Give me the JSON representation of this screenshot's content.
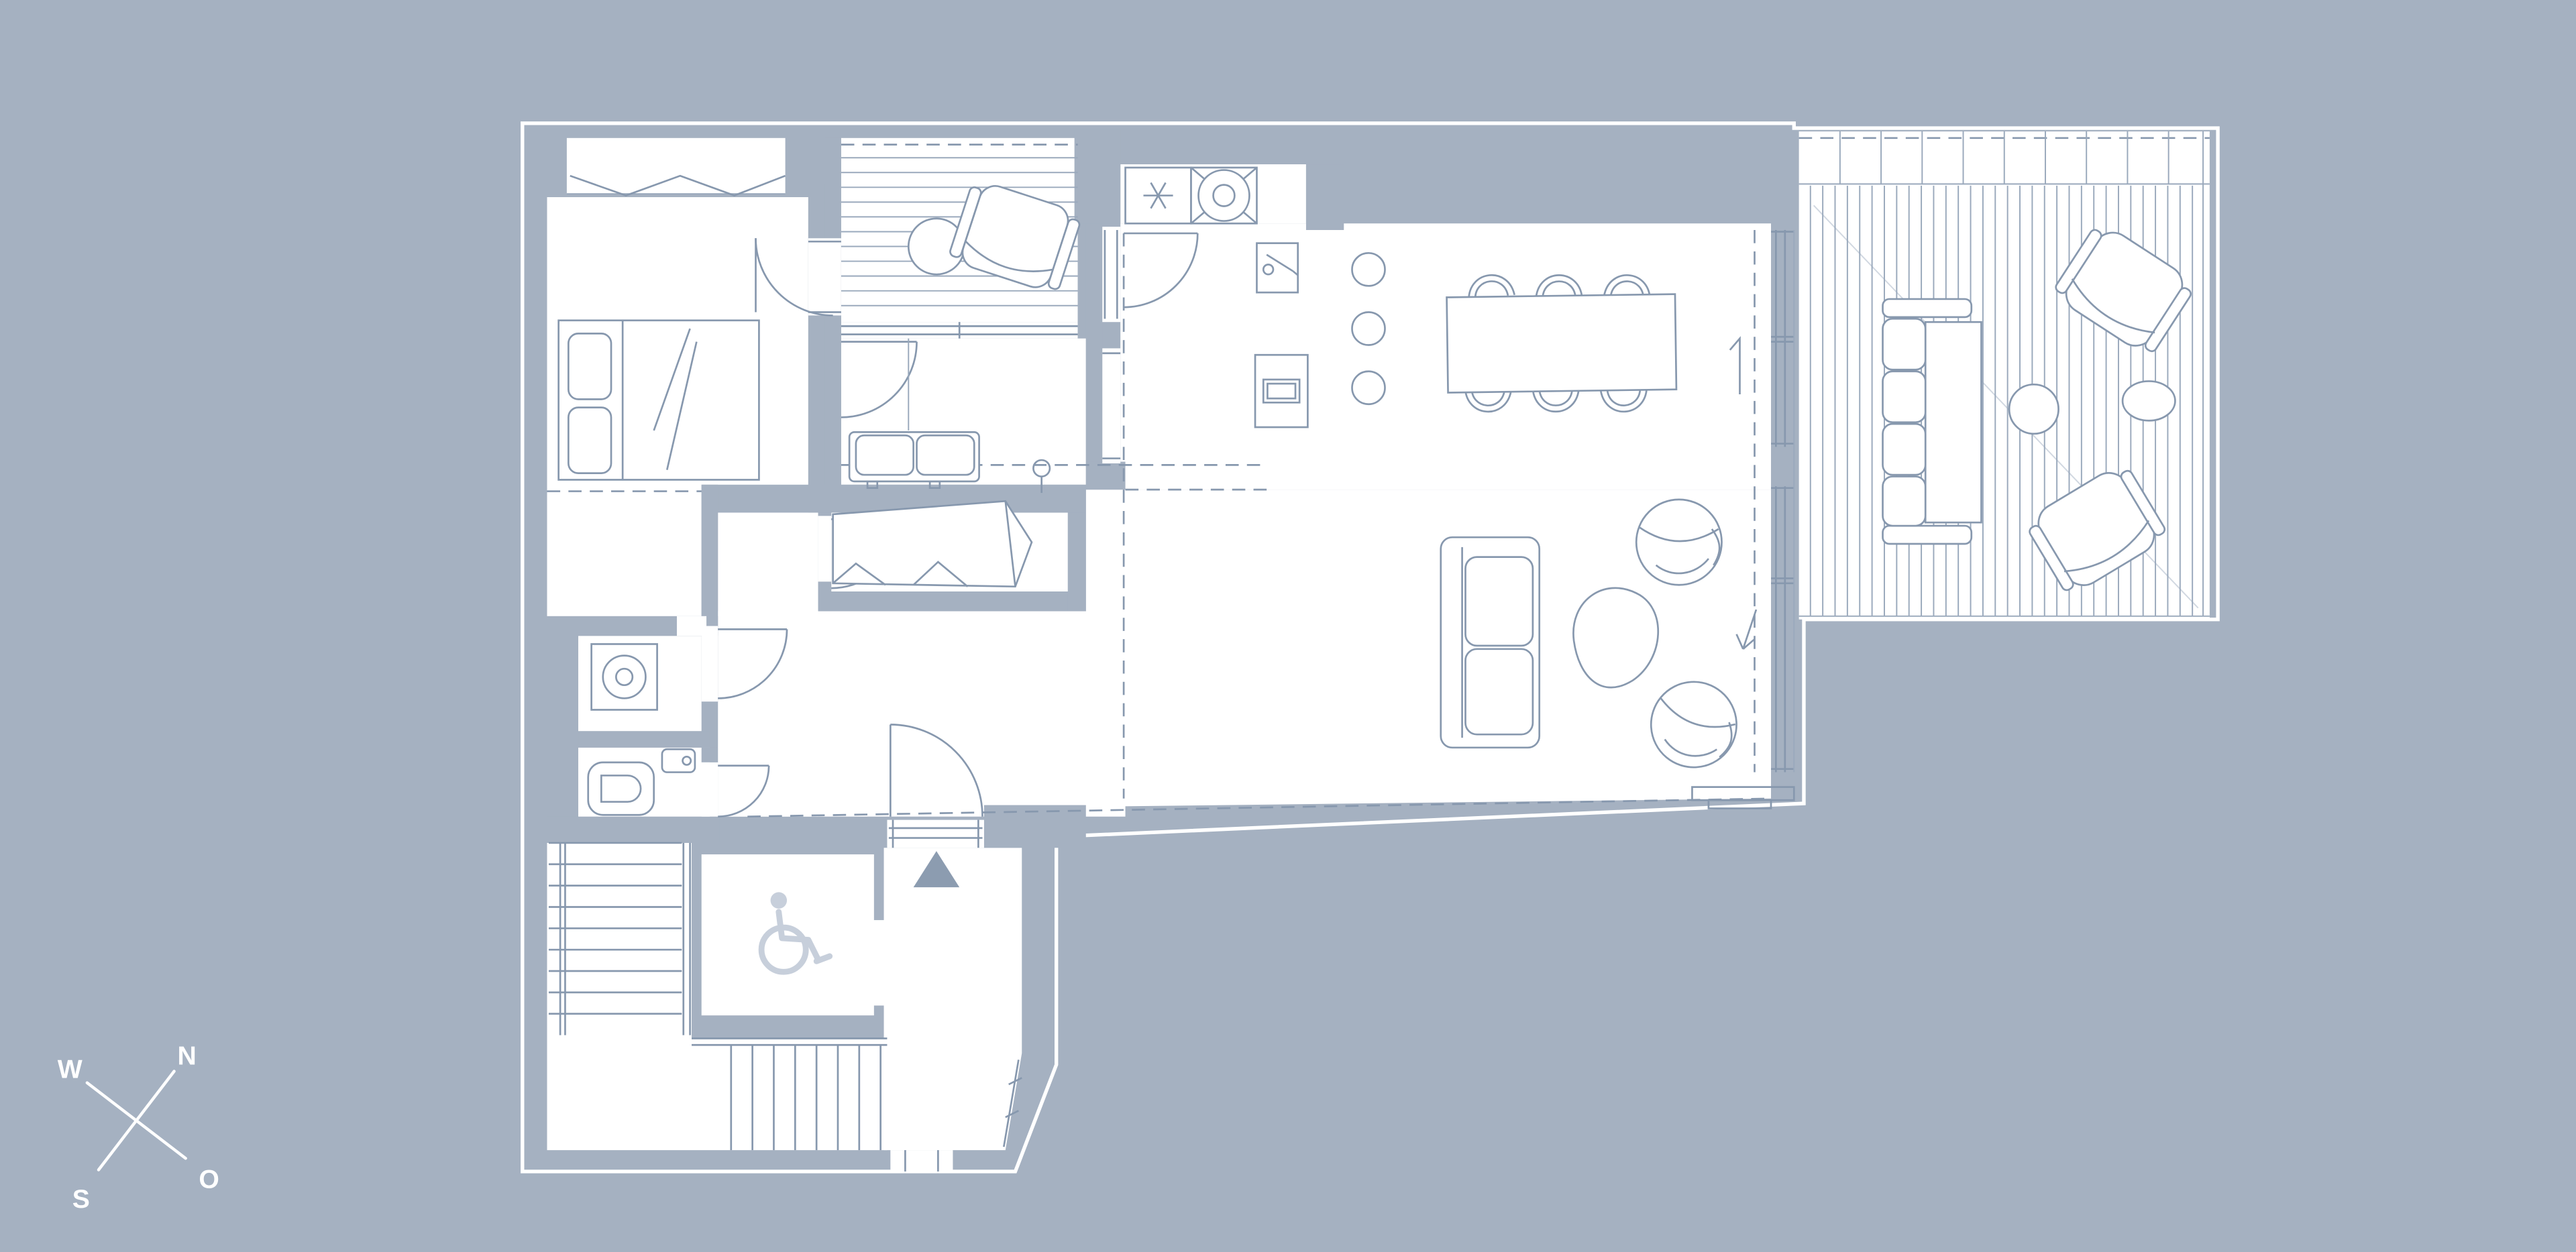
{
  "meta": {
    "kind": "architectural-floor-plan",
    "style": "white linework on slate-blue background"
  },
  "colors": {
    "bg": "#a5b1c1",
    "wall": "#a5b1c1",
    "line": "#8798ae",
    "line-light": "#9aa9bc",
    "symbol": "#c7cfdb",
    "arrow": "#8c9cb0",
    "white": "#ffffff"
  },
  "compass": {
    "north": "N",
    "east": "O",
    "south": "S",
    "west": "W"
  },
  "icons": [
    "compass-rose-icon",
    "wheelchair-accessible-icon",
    "entrance-direction-triangle-icon",
    "freezer-asterisk-icon",
    "stove-burner-icon",
    "sink-faucet-icon",
    "washing-machine-icon",
    "toilet-icon",
    "ceiling-lamp-icon"
  ],
  "counts": {
    "dining_chairs": 6,
    "kitchen_stools": 3,
    "upper_stair_treads": 9,
    "lower_stair_treads": 8,
    "balcony_deck_boards": 11,
    "terrace_deck_boards": 32,
    "terrace_lounge_chairs": 2,
    "living_room_swivel_chairs": 2
  }
}
